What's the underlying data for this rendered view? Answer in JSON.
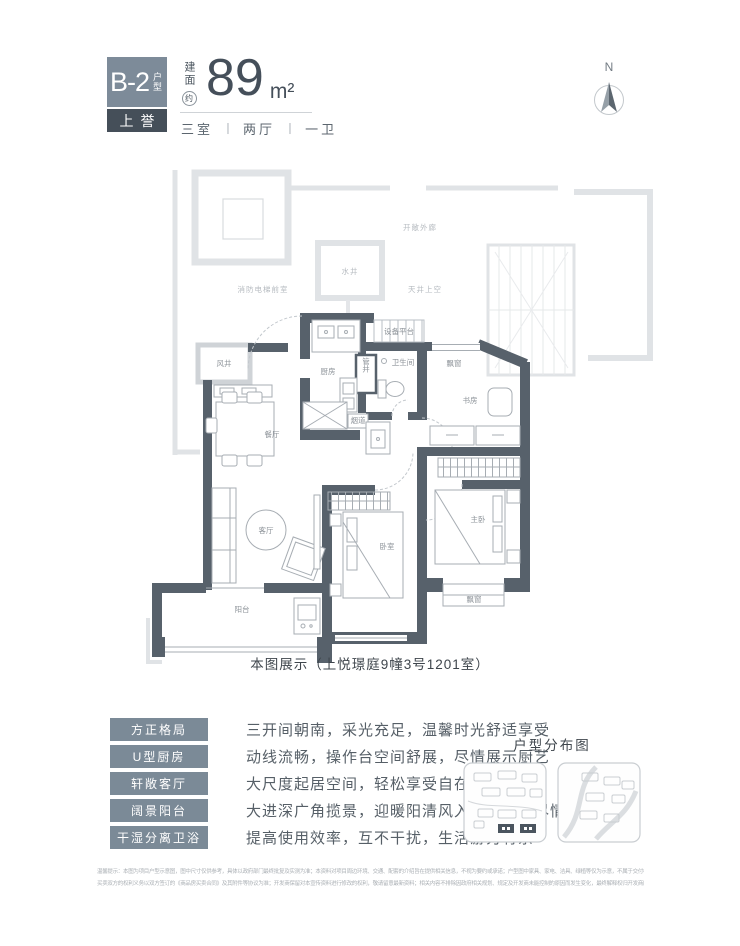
{
  "header": {
    "unit_code": "B-2",
    "unit_code_suffix": "户型",
    "sub_badge_char1": "上",
    "sub_badge_char2": "誉",
    "area_label_vertical": "建面",
    "area_circle_char": "约",
    "area_value": "89",
    "area_unit": "m²",
    "rooms_1": "三室",
    "rooms_2": "两厅",
    "rooms_3": "一卫",
    "separator": "丨",
    "compass_n": "N"
  },
  "colors": {
    "wall": "#57616b",
    "badge": "#7d8b99",
    "badge_dark": "#454f59",
    "tag": "#7b8a97",
    "context_gray": "#e0e3e6"
  },
  "floor_plan": {
    "context_labels": {
      "open_corridor": "开敞外廊",
      "water_shaft": "水井",
      "fire_elevator_lobby": "消防电梯前室",
      "lightwell_above": "天井上空",
      "air_shaft": "风井"
    },
    "room_labels": {
      "kitchen": "厨房",
      "equipment_platform": "设备平台",
      "pipe_shaft": "管井",
      "bathroom": "卫生间",
      "bay_window_top": "飘窗",
      "study": "书房",
      "dining_room": "餐厅",
      "living_room": "客厅",
      "bedroom": "卧室",
      "master_bedroom": "主卧",
      "bay_window_bottom": "飘窗",
      "balcony": "阳台",
      "flue": "烟道"
    },
    "caption": "本图展示（上悦璟庭9幢3号1201室）"
  },
  "features": {
    "items": [
      {
        "tag": "方正格局",
        "desc": "三开间朝南，采光充足，温馨时光舒适享受"
      },
      {
        "tag": "U型厨房",
        "desc": "动线流畅，操作台空间舒展，尽情展示厨艺"
      },
      {
        "tag": "轩敞客厅",
        "desc": "大尺度起居空间，轻松享受自在与惬意"
      },
      {
        "tag": "阔景阳台",
        "desc": "大进深广角揽景，迎暖阳清风入室，好景尽情收藏"
      },
      {
        "tag": "干湿分离卫浴",
        "desc": "提高使用效率，互不干扰，生活游刃有余"
      }
    ]
  },
  "distribution": {
    "title": "户型分布图"
  },
  "disclaimer": {
    "line1": "温馨提示：本图为项目户型示意图，图中尺寸仅供参考，具体以政府部门最终批复及实测为准；本资料对项目周边环境、交通、配套的介绍旨在提供相关信息，不视为要约或承诺；户型图中家具、家电、洁具、绿植等仅为示意，不属于交付标准。",
    "line2": "买卖双方的权利义务以双方签订的《商品房买卖合同》及其附件等协议为准；开发商保留对本宣传资料进行修改的权利，敬请留意最新资料；相关内容不排除因政府相关规划、规定及开发商未能控制的原因而发生变化，最终解释权归开发商所有。"
  }
}
